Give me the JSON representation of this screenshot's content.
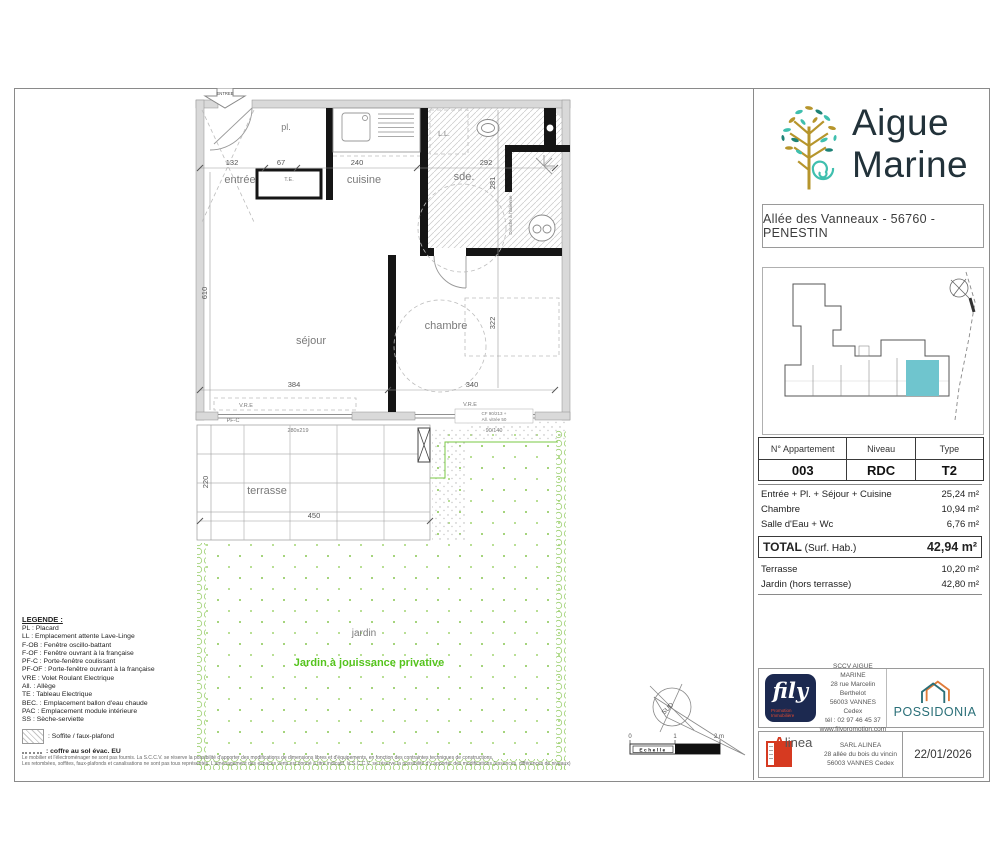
{
  "brand": {
    "line1": "Aigue",
    "line2": "Marine",
    "address": "Allée des Vanneaux - 56760 - PENESTIN"
  },
  "apartment": {
    "headers": [
      "N° Appartement",
      "Niveau",
      "Type"
    ],
    "number": "003",
    "level": "RDC",
    "type": "T2"
  },
  "surfaces": {
    "rows": [
      {
        "label": "Entrée + Pl. + Séjour + Cuisine",
        "value": "25,24 m²"
      },
      {
        "label": "Chambre",
        "value": "10,94 m²"
      },
      {
        "label": "Salle d'Eau + Wc",
        "value": "6,76 m²"
      }
    ],
    "total_strong": "TOTAL",
    "total_rest": " (Surf. Hab.)",
    "total_value": "42,94 m²",
    "extra": [
      {
        "label": "Terrasse",
        "value": "10,20 m²"
      },
      {
        "label": "Jardin (hors terrasse)",
        "value": "42,80 m²"
      }
    ]
  },
  "plan": {
    "entrance_arrow": "ENTREE",
    "rooms": {
      "entree": "entrée",
      "placard": "pl.",
      "cuisine": "cuisine",
      "sde": "sde.",
      "sejour": "séjour",
      "chambre": "chambre",
      "terrasse": "terrasse",
      "jardin": "jardin"
    },
    "jardin_caption": "Jardin à jouissance privative",
    "dims": {
      "entree": "132",
      "placard": "67",
      "cuisine": "240",
      "sde_w": "292",
      "sde_h": "281",
      "sejour_h": "610",
      "sejour_w": "384",
      "chambre_w": "340",
      "chambre_h": "322",
      "terrasse_h": "220",
      "terrasse_w": "450"
    },
    "annotations": {
      "te": "T.E.",
      "ll": "L.L.",
      "vre_left": "V.R.E",
      "vre_right": "V.R.E",
      "pfc": "PF-C",
      "pfc_size": "280x219",
      "cf_line1": "CF 90/213 +",
      "cf_line2": "All. vitrée 50",
      "win_size": "90/140",
      "douche": "Douche à l'italienne"
    },
    "compass_label": "SUD",
    "scale": {
      "t0": "0",
      "t1": "1",
      "t2": "2 m",
      "label": "Echelle"
    }
  },
  "legend": {
    "title": "LEGENDE :",
    "items": [
      "PL : Placard",
      "LL : Emplacement attente Lave-Linge",
      "F-OB : Fenêtre oscillo-battant",
      "F-OF : Fenêtre ouvrant à la française",
      "PF-C : Porte-fenêtre coulissant",
      "PF-OF : Porte-fenêtre ouvrant à la française",
      "VRE : Volet Roulant Electrique",
      "All. : Allège",
      "TE : Tableau Electrique",
      "BEC. : Emplacement ballon d'eau chaude",
      "PAC : Emplacement module intérieure",
      "SS : Sèche-serviette"
    ],
    "soffite": ": Soffite / faux-plafond",
    "coffre": ": coffre au sol évac. EU"
  },
  "disclaimer": {
    "line1": "Le mobilier et l'électroménager ne sont pas fournis. La S.C.C.V. se réserve la possibilité d'apporter des modifications de dimensions libres et d'équipements, en fonction des contraintes techniques de constructions.",
    "line2": "Les retombées, soffites, faux-plafonds et canalisations ne sont pas tous représentés. L'aménagement des espaces verts est donné à titre indicatif, la S.C.C.V. se réserve la possibilité d'y apporter des modifications (essences, différences de niveaux)"
  },
  "promoter": {
    "logo_text": "fily",
    "caption1": "Promotion",
    "caption2": "Immobilière",
    "company": "SCCV AIGUE MARINE",
    "address1": "28 rue Marcelin Berthelot",
    "address2": "56003 VANNES Cedex",
    "phone": "tél : 02 97 46 45 37",
    "website": "www.filypromotion.com",
    "partner": "POSSIDONIA"
  },
  "architect": {
    "logo_a": "A",
    "logo_rest": "linea",
    "company": "SARL ALINEA",
    "address1": "28 allée du bois du vincin",
    "address2": "56003 VANNES Cedex",
    "date": "22/01/2026"
  },
  "colors": {
    "unit_highlight": "#6fc5ce",
    "logo_teal": "#3fbfae",
    "logo_gold": "#b6952c",
    "possidonia_teal": "#2a6f78",
    "possidonia_orange": "#e07b39",
    "fily_navy": "#1c2950",
    "alinea_red": "#d63a21",
    "garden_green": "#55c41d"
  }
}
